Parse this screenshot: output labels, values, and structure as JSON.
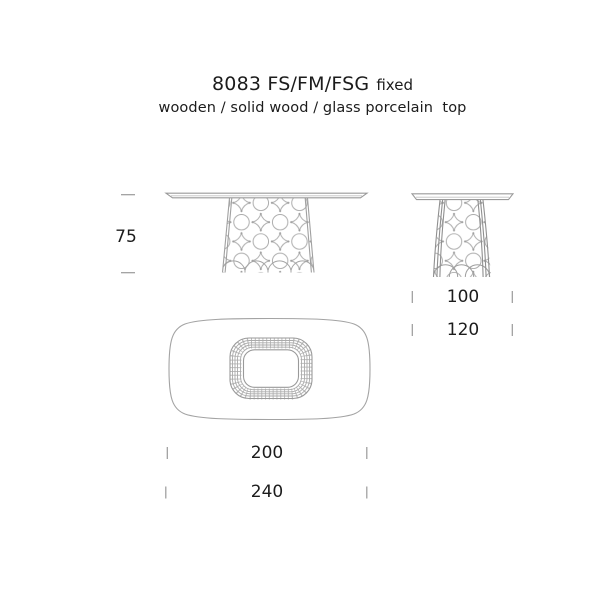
{
  "header": {
    "title": "8083 FS/FM/FSG",
    "title_suffix": "fixed",
    "subtitle": "wooden / solid wood / glass porcelain  top"
  },
  "dimensions": {
    "height_label": "75",
    "depth_labels": [
      "100",
      "120"
    ],
    "length_labels": [
      "200",
      "240"
    ]
  },
  "drawing": {
    "views": [
      "side-view",
      "end-view",
      "top-view"
    ],
    "colors": {
      "text": "#1c1c1c",
      "line": "#ababab",
      "line_dark": "#8f8f8f",
      "tick": "#9a9a9a"
    }
  }
}
